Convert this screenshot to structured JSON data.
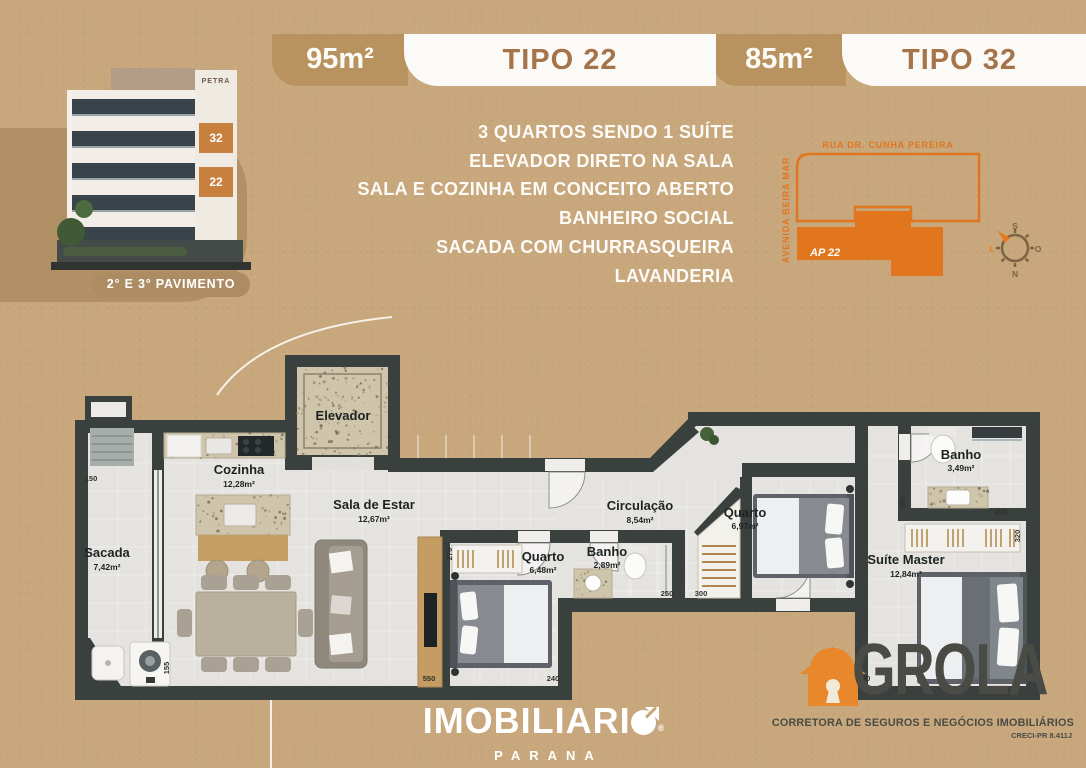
{
  "colors": {
    "background": "#c7a77b",
    "panel_tan": "#b19065",
    "chip_tan": "#b8935f",
    "tipo_brown": "#a5744a",
    "accent_orange": "#e2761f",
    "wall_dark": "#3a403e",
    "floor_light": "#e4e3e0",
    "logo_gray": "#4b4b45",
    "logo_orange": "#e8872b",
    "white": "#ffffff"
  },
  "header": {
    "plans": [
      {
        "area": "95m²",
        "tipo": "TIPO 22"
      },
      {
        "area": "85m²",
        "tipo": "TIPO 32"
      }
    ]
  },
  "building": {
    "sign": "PETRA",
    "unit_top": "32",
    "unit_bottom": "22",
    "badge": "2° E 3° PAVIMENTO"
  },
  "features": [
    "3 QUARTOS SENDO 1 SUÍTE",
    "ELEVADOR DIRETO NA SALA",
    "SALA E COZINHA EM CONCEITO ABERTO",
    "BANHEIRO SOCIAL",
    "SACADA COM CHURRASQUEIRA",
    "LAVANDERIA"
  ],
  "map": {
    "street_top": "RUA DR. CUNHA PEREIRA",
    "street_left": "AVENIDA BEIRA MAR",
    "unit_label": "AP 22",
    "compass": {
      "top": "S",
      "left": "L",
      "right": "O",
      "bottom": "N"
    }
  },
  "floorplan": {
    "rooms": [
      {
        "name": "Elevador",
        "area": ""
      },
      {
        "name": "Cozinha",
        "area": "12,28m²"
      },
      {
        "name": "Sala de Estar",
        "area": "12,67m²"
      },
      {
        "name": "Sacada",
        "area": "7,42m²"
      },
      {
        "name": "Quarto",
        "area": "6,48m²"
      },
      {
        "name": "Banho",
        "area": "2,89m²"
      },
      {
        "name": "Circulação",
        "area": "8,54m²"
      },
      {
        "name": "Quarto",
        "area": "6,97m²"
      },
      {
        "name": "Banho",
        "area": "3,49m²"
      },
      {
        "name": "Suíte Master",
        "area": "12,84m²"
      }
    ],
    "dimensions": [
      "150",
      "155",
      "270",
      "550",
      "240",
      "250",
      "300",
      "190",
      "205",
      "320",
      "130"
    ]
  },
  "footer": {
    "brand_prefix": "IMOBILIARI",
    "registered": "®",
    "region": "PARANA",
    "partner": "GROLA",
    "partner_subtitle": "CORRETORA DE SEGUROS E NEGÓCIOS IMOBILIÁRIOS",
    "partner_creci": "CRECI-PR 8.411J"
  }
}
